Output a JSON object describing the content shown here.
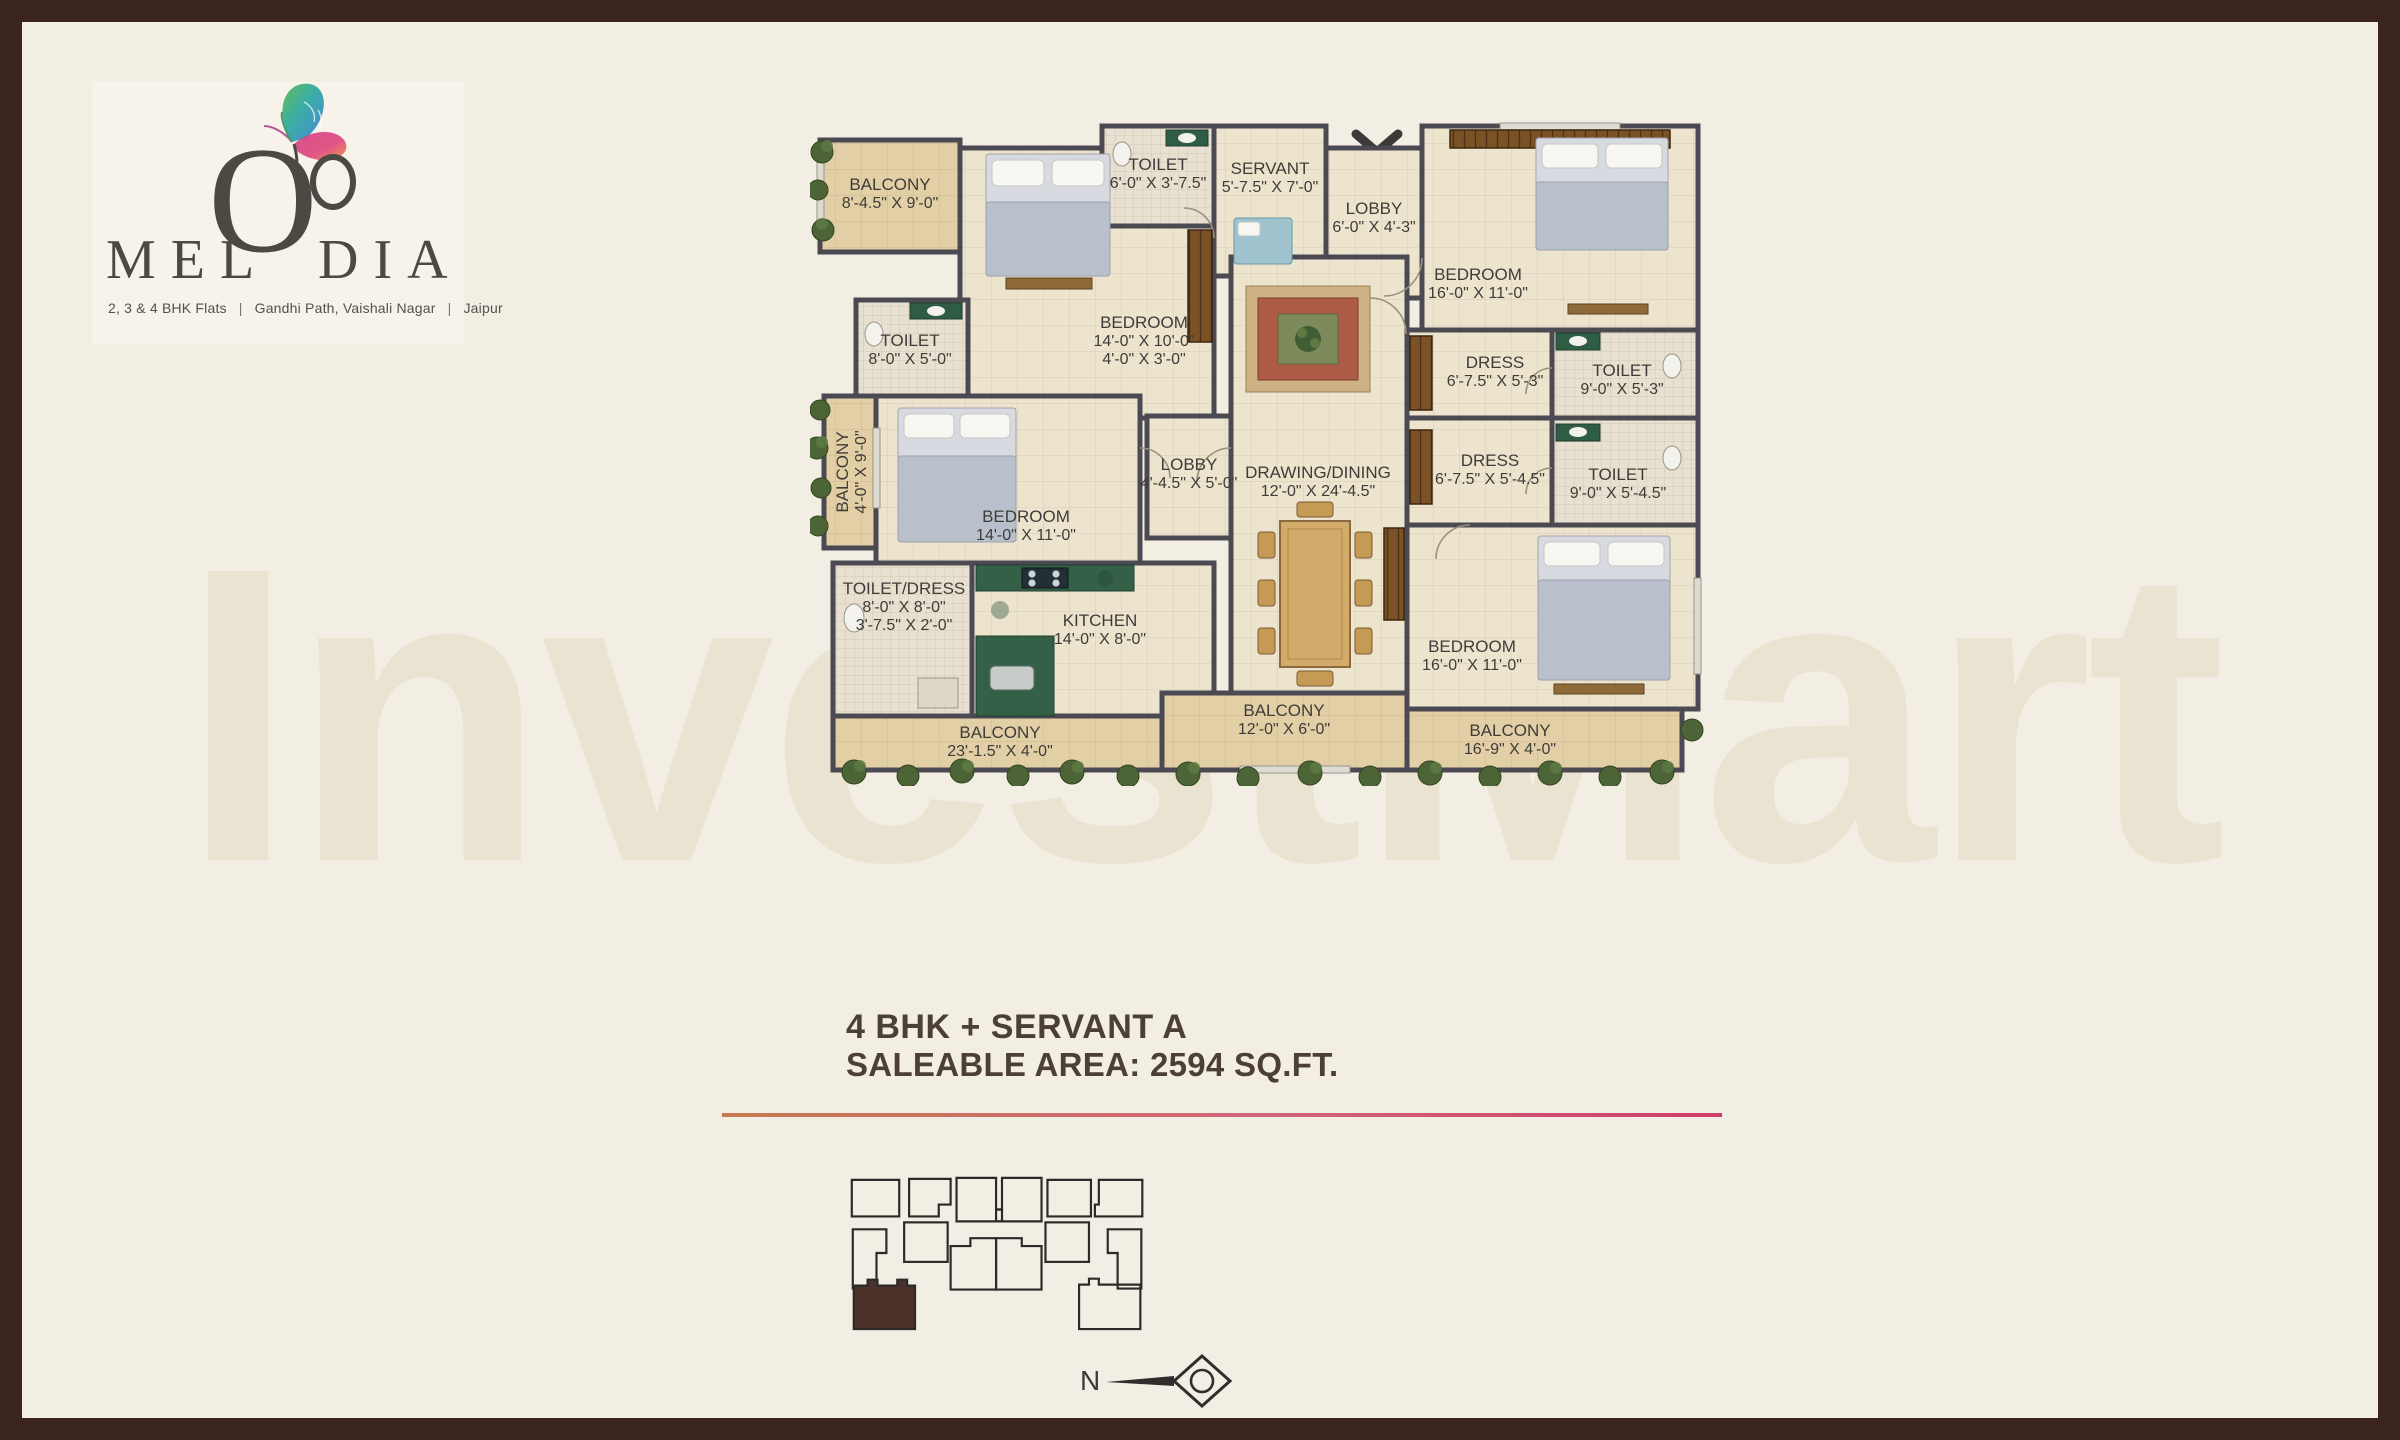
{
  "brand": {
    "name_pre": "MEL",
    "name_o": "O",
    "name_post": "DIA",
    "tagline": {
      "item1": "2, 3 & 4 BHK Flats",
      "sep1": "|",
      "item2": "Gandhi Path, Vaishali Nagar",
      "sep2": "|",
      "item3": "Jaipur"
    }
  },
  "watermark": "InvestMart",
  "unit": {
    "title": "4 BHK + SERVANT A",
    "area": "SALEABLE AREA: 2594 SQ.FT."
  },
  "compass": {
    "north_label": "N"
  },
  "plan": {
    "rooms": {
      "balcony_tl": {
        "name": "BALCONY",
        "dim": "8'-4.5\" X 9'-0\""
      },
      "toilet_top": {
        "name": "TOILET",
        "dim": "6'-0\" X 3'-7.5\""
      },
      "servant": {
        "name": "SERVANT",
        "dim": "5'-7.5\" X 7'-0\""
      },
      "lobby_top": {
        "name": "LOBBY",
        "dim": "6'-0\" X 4'-3\""
      },
      "bedroom_tr": {
        "name": "BEDROOM",
        "dim": "16'-0\" X 11'-0\""
      },
      "toilet_left": {
        "name": "TOILET",
        "dim": "8'-0\" X 5'-0\""
      },
      "bedroom_tm": {
        "name": "BEDROOM",
        "dim": "14'-0\" X 10'-0\"",
        "dim2": "4'-0\" X 3'-0\""
      },
      "balcony_left": {
        "name": "BALCONY",
        "dim": "4'-0\" X 9'-0\""
      },
      "dress_u": {
        "name": "DRESS",
        "dim": "6'-7.5\" X 5'-3\""
      },
      "toilet_ur": {
        "name": "TOILET",
        "dim": "9'-0\" X 5'-3\""
      },
      "lobby_mid": {
        "name": "LOBBY",
        "dim": "4'-4.5\" X 5'-0\""
      },
      "drawing": {
        "name": "DRAWING/DINING",
        "dim": "12'-0\" X 24'-4.5\""
      },
      "dress_l": {
        "name": "DRESS",
        "dim": "6'-7.5\" X 5'-4.5\""
      },
      "toilet_lr": {
        "name": "TOILET",
        "dim": "9'-0\" X 5'-4.5\""
      },
      "bedroom_ml": {
        "name": "BEDROOM",
        "dim": "14'-0\" X 11'-0\""
      },
      "toilet_dress": {
        "name": "TOILET/DRESS",
        "dim": "8'-0\" X 8'-0\"",
        "dim2": "3'-7.5\" X 2'-0\""
      },
      "kitchen": {
        "name": "KITCHEN",
        "dim": "14'-0\" X 8'-0\""
      },
      "bedroom_br": {
        "name": "BEDROOM",
        "dim": "16'-0\" X 11'-0\""
      },
      "balcony_b1": {
        "name": "BALCONY",
        "dim": "23'-1.5\" X 4'-0\""
      },
      "balcony_b2": {
        "name": "BALCONY",
        "dim": "12'-0\" X 6'-0\""
      },
      "balcony_b3": {
        "name": "BALCONY",
        "dim": "16'-9\" X 4'-0\""
      }
    }
  },
  "colors": {
    "frame": "#3a241d",
    "background": "#f2eee3",
    "divider_left": "#c77950",
    "divider_right": "#cf3f68",
    "keyplan_highlight": "#4b3129",
    "wall": "#4b4a52",
    "balcony_fill": "#e3cfa6",
    "room_fill": "#ece4cd",
    "kitchen_green": "#356048"
  }
}
